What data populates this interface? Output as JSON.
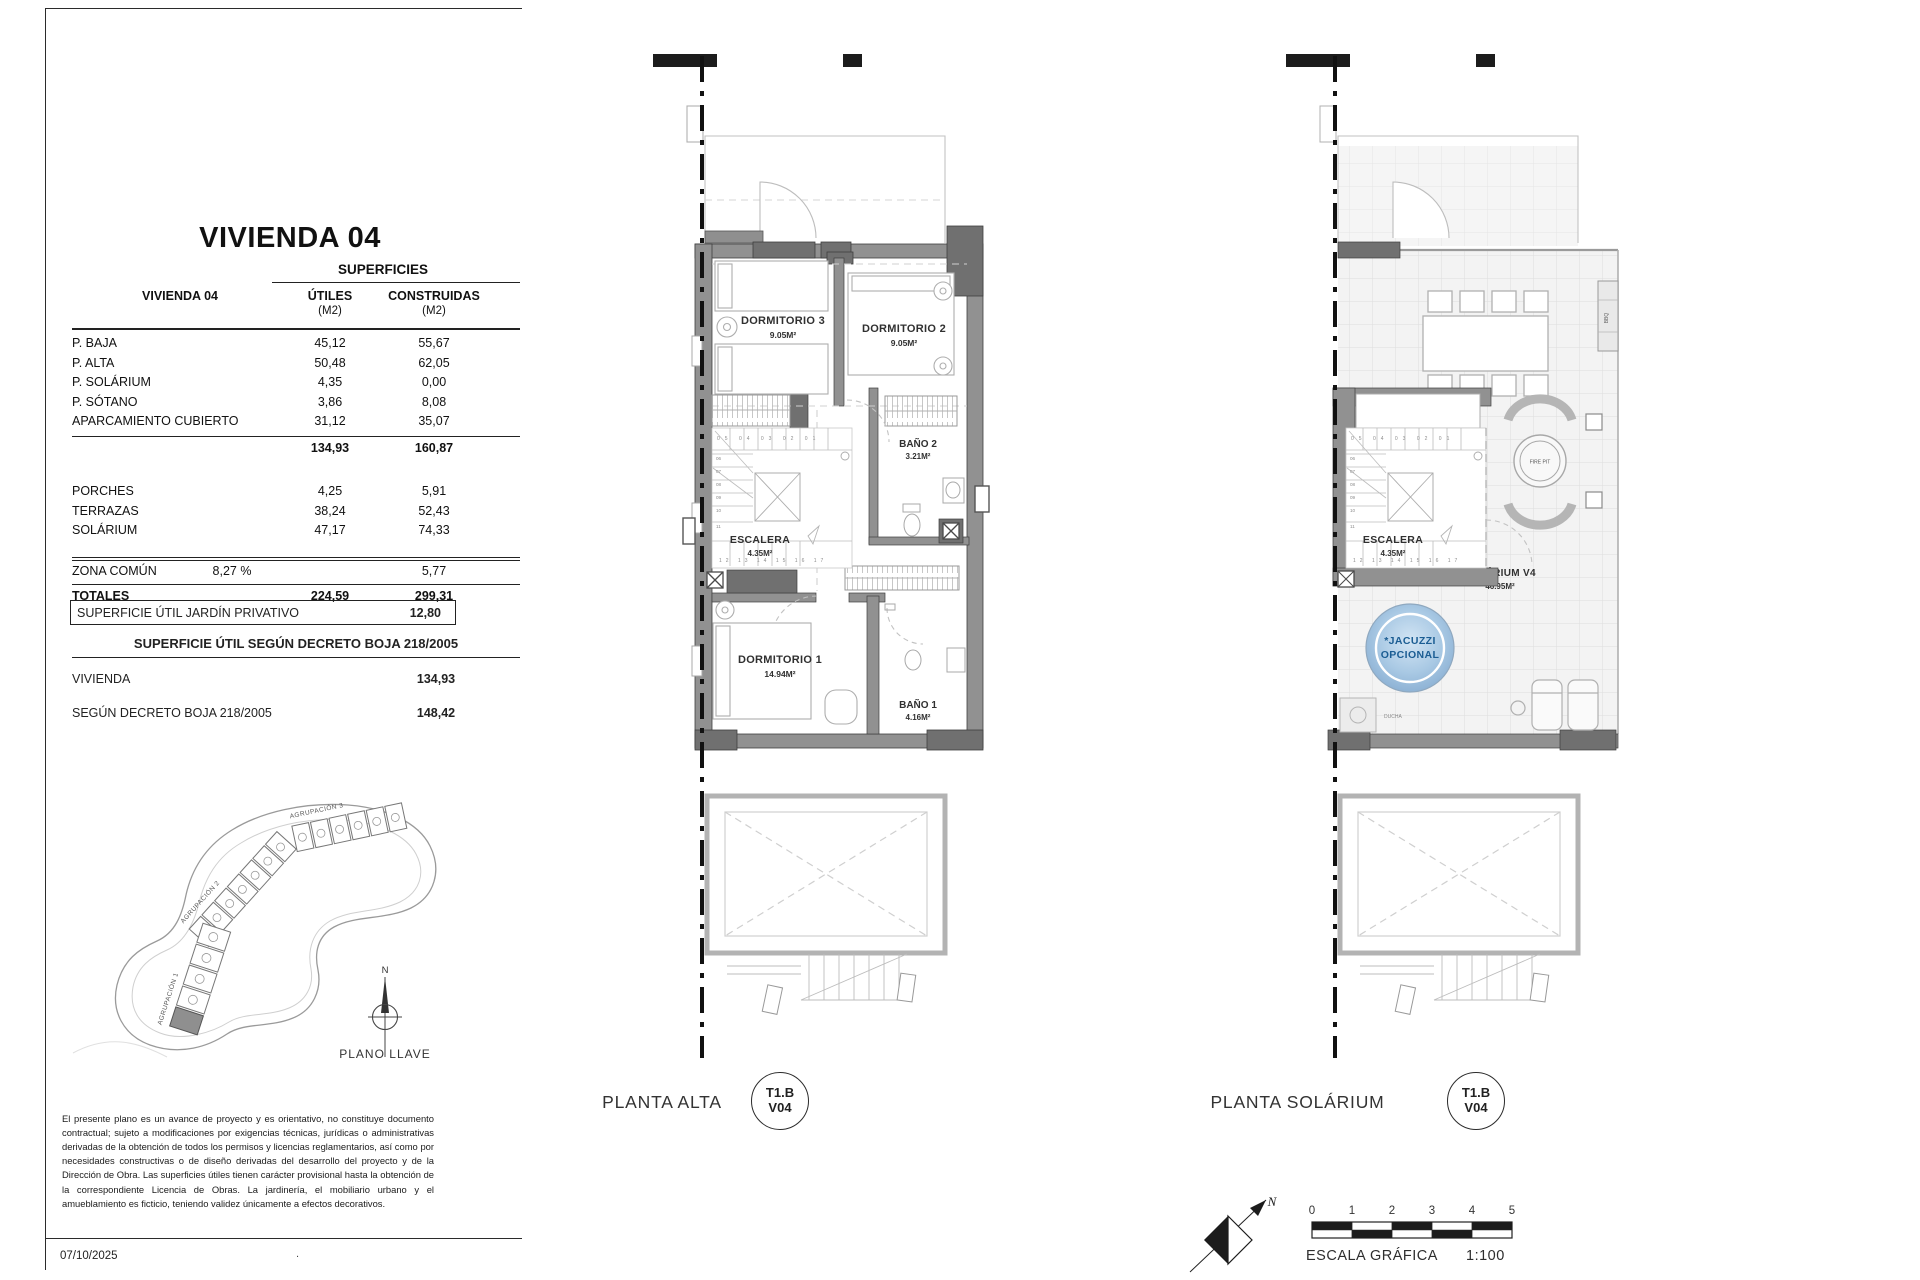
{
  "panel": {
    "title": "VIVIENDA 04",
    "table": {
      "group_header": "SUPERFICIES",
      "col_label": "VIVIENDA 04",
      "col_utiles": "ÚTILES",
      "col_utiles_unit": "(M2)",
      "col_construidas": "CONSTRUIDAS",
      "col_construidas_unit": "(M2)",
      "rows": [
        {
          "label": "P. BAJA",
          "utiles": "45,12",
          "construidas": "55,67"
        },
        {
          "label": "P. ALTA",
          "utiles": "50,48",
          "construidas": "62,05"
        },
        {
          "label": "P. SOLÁRIUM",
          "utiles": "4,35",
          "construidas": "0,00"
        },
        {
          "label": "P. SÓTANO",
          "utiles": "3,86",
          "construidas": "8,08"
        },
        {
          "label": "APARCAMIENTO CUBIERTO",
          "utiles": "31,12",
          "construidas": "35,07"
        }
      ],
      "subtotal": {
        "utiles": "134,93",
        "construidas": "160,87"
      },
      "rows2": [
        {
          "label": "PORCHES",
          "utiles": "4,25",
          "construidas": "5,91"
        },
        {
          "label": "TERRAZAS",
          "utiles": "38,24",
          "construidas": "52,43"
        },
        {
          "label": "SOLÁRIUM",
          "utiles": "47,17",
          "construidas": "74,33"
        }
      ],
      "zona_comun": {
        "label": "ZONA COMÚN",
        "pct": "8,27 %",
        "construidas": "5,77"
      },
      "totales": {
        "label": "TOTALES",
        "utiles": "224,59",
        "construidas": "299,31"
      },
      "jardin": {
        "label": "SUPERFICIE ÚTIL JARDÍN PRIVATIVO",
        "value": "12,80"
      },
      "decreto_header": "SUPERFICIE ÚTIL SEGÚN DECRETO BOJA 218/2005",
      "decreto_rows": [
        {
          "label": "VIVIENDA",
          "value": "134,93"
        },
        {
          "label": "SEGÚN DECRETO BOJA 218/2005",
          "value": "148,42"
        }
      ]
    },
    "keyplan": {
      "north": "N",
      "label": "PLANO LLAVE",
      "groups": [
        "AGRUPACIÓN 1",
        "AGRUPACIÓN 2",
        "AGRUPACIÓN 3"
      ]
    },
    "disclaimer": "El presente plano es un avance de proyecto y es orientativo, no constituye documento contractual; sujeto a modificaciones por exigencias técnicas, jurídicas o administrativas derivadas de la obtención de todos los permisos y licencias reglamentarios, así como por necesidades constructivas o de diseño derivadas del desarrollo del proyecto y de la Dirección de Obra. Las superficies útiles tienen carácter provisional hasta la obtención de la correspondiente Licencia de Obras. La jardinería, el mobiliario urbano y el amueblamiento es ficticio, teniendo validez únicamente a efectos decorativos.",
    "date": "07/10/2025",
    "stray_dot": "."
  },
  "stairs": {
    "top": "05 04 03 02 01",
    "left": [
      "06",
      "07",
      "08",
      "09",
      "10",
      "11"
    ],
    "bottom": "12 13 14 15 16 17"
  },
  "plan_alta": {
    "name": "PLANTA ALTA",
    "badge": {
      "l1": "T1.B",
      "l2": "V04"
    },
    "rooms": {
      "dorm3": {
        "name": "DORMITORIO 3",
        "area": "9.05M²"
      },
      "dorm2": {
        "name": "DORMITORIO 2",
        "area": "9.05M²"
      },
      "bano2": {
        "name": "BAÑO 2",
        "area": "3.21M²"
      },
      "paso": {
        "name": "PASO",
        "area": "5.43M²"
      },
      "escalera": {
        "name": "ESCALERA",
        "area": "4.35M²"
      },
      "dorm1": {
        "name": "DORMITORIO 1",
        "area": "14.94M²"
      },
      "bano1": {
        "name": "BAÑO 1",
        "area": "4.16M²"
      }
    }
  },
  "plan_solarium": {
    "name": "PLANTA SOLÁRIUM",
    "badge": {
      "l1": "T1.B",
      "l2": "V04"
    },
    "labels": {
      "escalera": {
        "name": "ESCALERA",
        "area": "4.35M²"
      },
      "solarium": {
        "name": "SOLÁRIUM V4",
        "area": "46.95M²"
      },
      "jacuzzi1": "*JACUZZI",
      "jacuzzi2": "OPCIONAL",
      "bbq": "BBQ",
      "firepit": "FIRE PIT",
      "ducha": "DUCHA"
    }
  },
  "footer": {
    "north": "N",
    "scale": {
      "numbers": [
        "0",
        "1",
        "2",
        "3",
        "4",
        "5"
      ],
      "label": "ESCALA GRÁFICA",
      "ratio": "1:100"
    }
  },
  "colors": {
    "wall": "#919191",
    "wall_dark": "#707070",
    "jacuzzi_blue": "#9ec1e0",
    "jacuzzi_text": "#1b5d93"
  }
}
